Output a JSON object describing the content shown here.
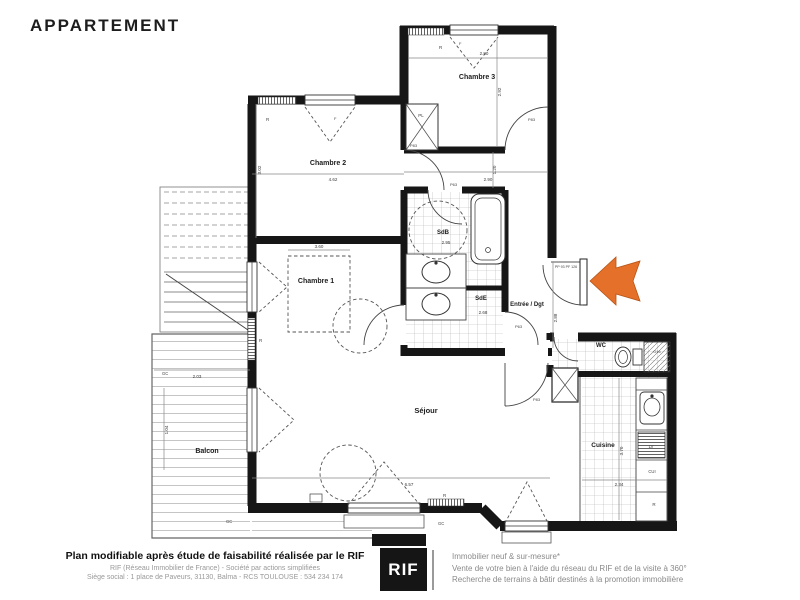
{
  "header": {
    "title": "APPARTEMENT"
  },
  "colors": {
    "wall": "#161616",
    "arrow": "#e4702a",
    "arrow_edge": "#b55417"
  },
  "plan": {
    "rooms": {
      "chambre2": {
        "name": "Chambre 2",
        "w": "4.62",
        "h": "3.02"
      },
      "chambre1": {
        "name": "Chambre 1"
      },
      "chambre3": {
        "name": "Chambre 3",
        "w": "2.80",
        "h": "2.92"
      },
      "sdb": {
        "name": "SdB",
        "dim": "2.95"
      },
      "sde": {
        "name": "SdE",
        "dim": "2.68"
      },
      "entree": {
        "name": "Entrée / Dgt",
        "h": "2.88"
      },
      "wc": {
        "name": "WC"
      },
      "sejour": {
        "name": "Séjour",
        "w": "6.57"
      },
      "cuisine": {
        "name": "Cuisine",
        "h": "3.70",
        "w": "2.34"
      },
      "balcon": {
        "name": "Balcon",
        "w": "2.03",
        "h": "1.04"
      }
    },
    "dims": {
      "hall_w": "2.90",
      "hall_h": "1.20",
      "bed": "3.60"
    },
    "tags": {
      "closet": "PL",
      "radiator": "R",
      "window": "F",
      "guardrail": "GC",
      "dishwasher": "LV",
      "cooker": "CUI",
      "fridge": "R",
      "shaft": "O16",
      "door83": "P83",
      "door63": "P63",
      "entry_door": "PP 93 PF 126"
    }
  },
  "footer": {
    "left_bold": "Plan modifiable après étude de faisabilité réalisée par le RIF",
    "left_line1": "RIF (Réseau Immobilier de France) - Société par actions simplifiées",
    "left_line2": "Siège social : 1 place de Paveurs, 31130, Balma - RCS TOULOUSE : 534 234 174",
    "logo": "RIF",
    "right_line1": "Immobilier neuf & sur-mesure*",
    "right_line2": "Vente de votre bien à l'aide du réseau du RIF et de la visite à 360°",
    "right_line3": "Recherche de terrains à bâtir destinés à la promotion immobilière"
  }
}
